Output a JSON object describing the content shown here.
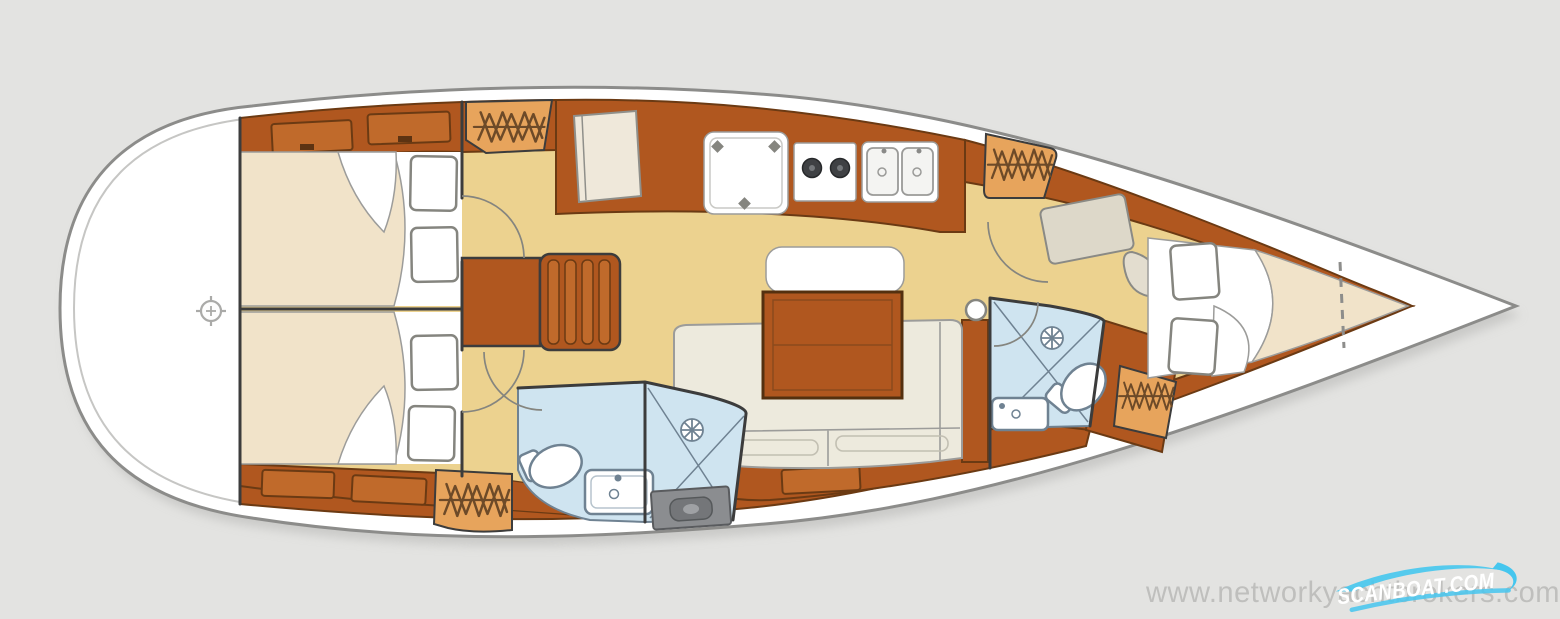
{
  "meta": {
    "subject": "sailing-yacht-interior-floor-plan",
    "view": "top-down",
    "orientation": "bow-right"
  },
  "watermark": {
    "site_url": "www.networkyachtbrokers.com"
  },
  "logo": {
    "brand": "SCANBOAT.COM"
  },
  "colors": {
    "bg": "#e3e3e1",
    "shadow": "#b9b9b7",
    "hull": "#ffffff",
    "hull_outline": "#8c8c8a",
    "inner_line": "#c6c6c4",
    "floor": "#ecd28f",
    "wood": "#b0571f",
    "wood_light": "#c06a2b",
    "wood_edge": "#6b3a13",
    "bed": "#f1e3c9",
    "white": "#ffffff",
    "upholstery": "#edeadd",
    "heads": "#cfe4f0",
    "heads_line": "#6f8292",
    "wardrobe": "#e7a45c",
    "hanger": "#6d4a28",
    "grate": "#8b8d90",
    "line_dark": "#3c3c3c",
    "line_mid": "#85857f",
    "line_soft": "#9c9c9a",
    "watermark": "#9c9c9a",
    "logo_blue": "#45c6ee",
    "logo_text": "#ffffff"
  }
}
